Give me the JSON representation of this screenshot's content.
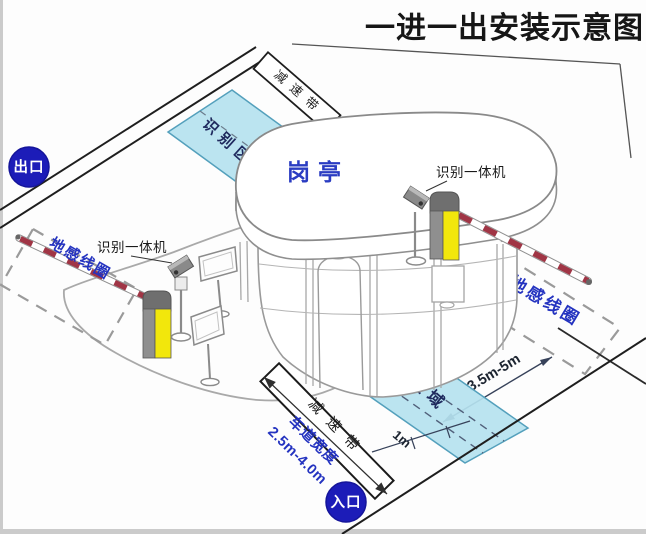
{
  "title": "一进一出安装示意图",
  "badges": {
    "exit": "出口",
    "entrance": "入口"
  },
  "booth": {
    "label": "岗亭"
  },
  "exit_lane": {
    "camera_label": "识别一体机",
    "ground_loop_label": "地感线圈",
    "recognition_zone_label": "识别区域",
    "speed_bump_label": "减速带"
  },
  "entry_lane": {
    "camera_label": "识别一体机",
    "ground_loop_label": "地感线圈",
    "recognition_zone_label": "识别区域",
    "speed_bump_label": "减速带",
    "lane_width_label": "车道宽度",
    "lane_width_value": "2.5m-4.0m",
    "loop_distance": "3.5m-5m",
    "zone_depth": "1m"
  },
  "colors": {
    "badge_blue": "#1c1cb8",
    "label_blue": "#2433c0",
    "dimension_navy": "#1c2430",
    "zone_fill": "#b5e2ef",
    "zone_stroke": "#54a0bc",
    "barrier_yellow": "#f2e70c",
    "barrier_gray": "#8f8f8f",
    "stripe_red": "#a03545",
    "booth_text_blue": "#2a3cc2"
  }
}
